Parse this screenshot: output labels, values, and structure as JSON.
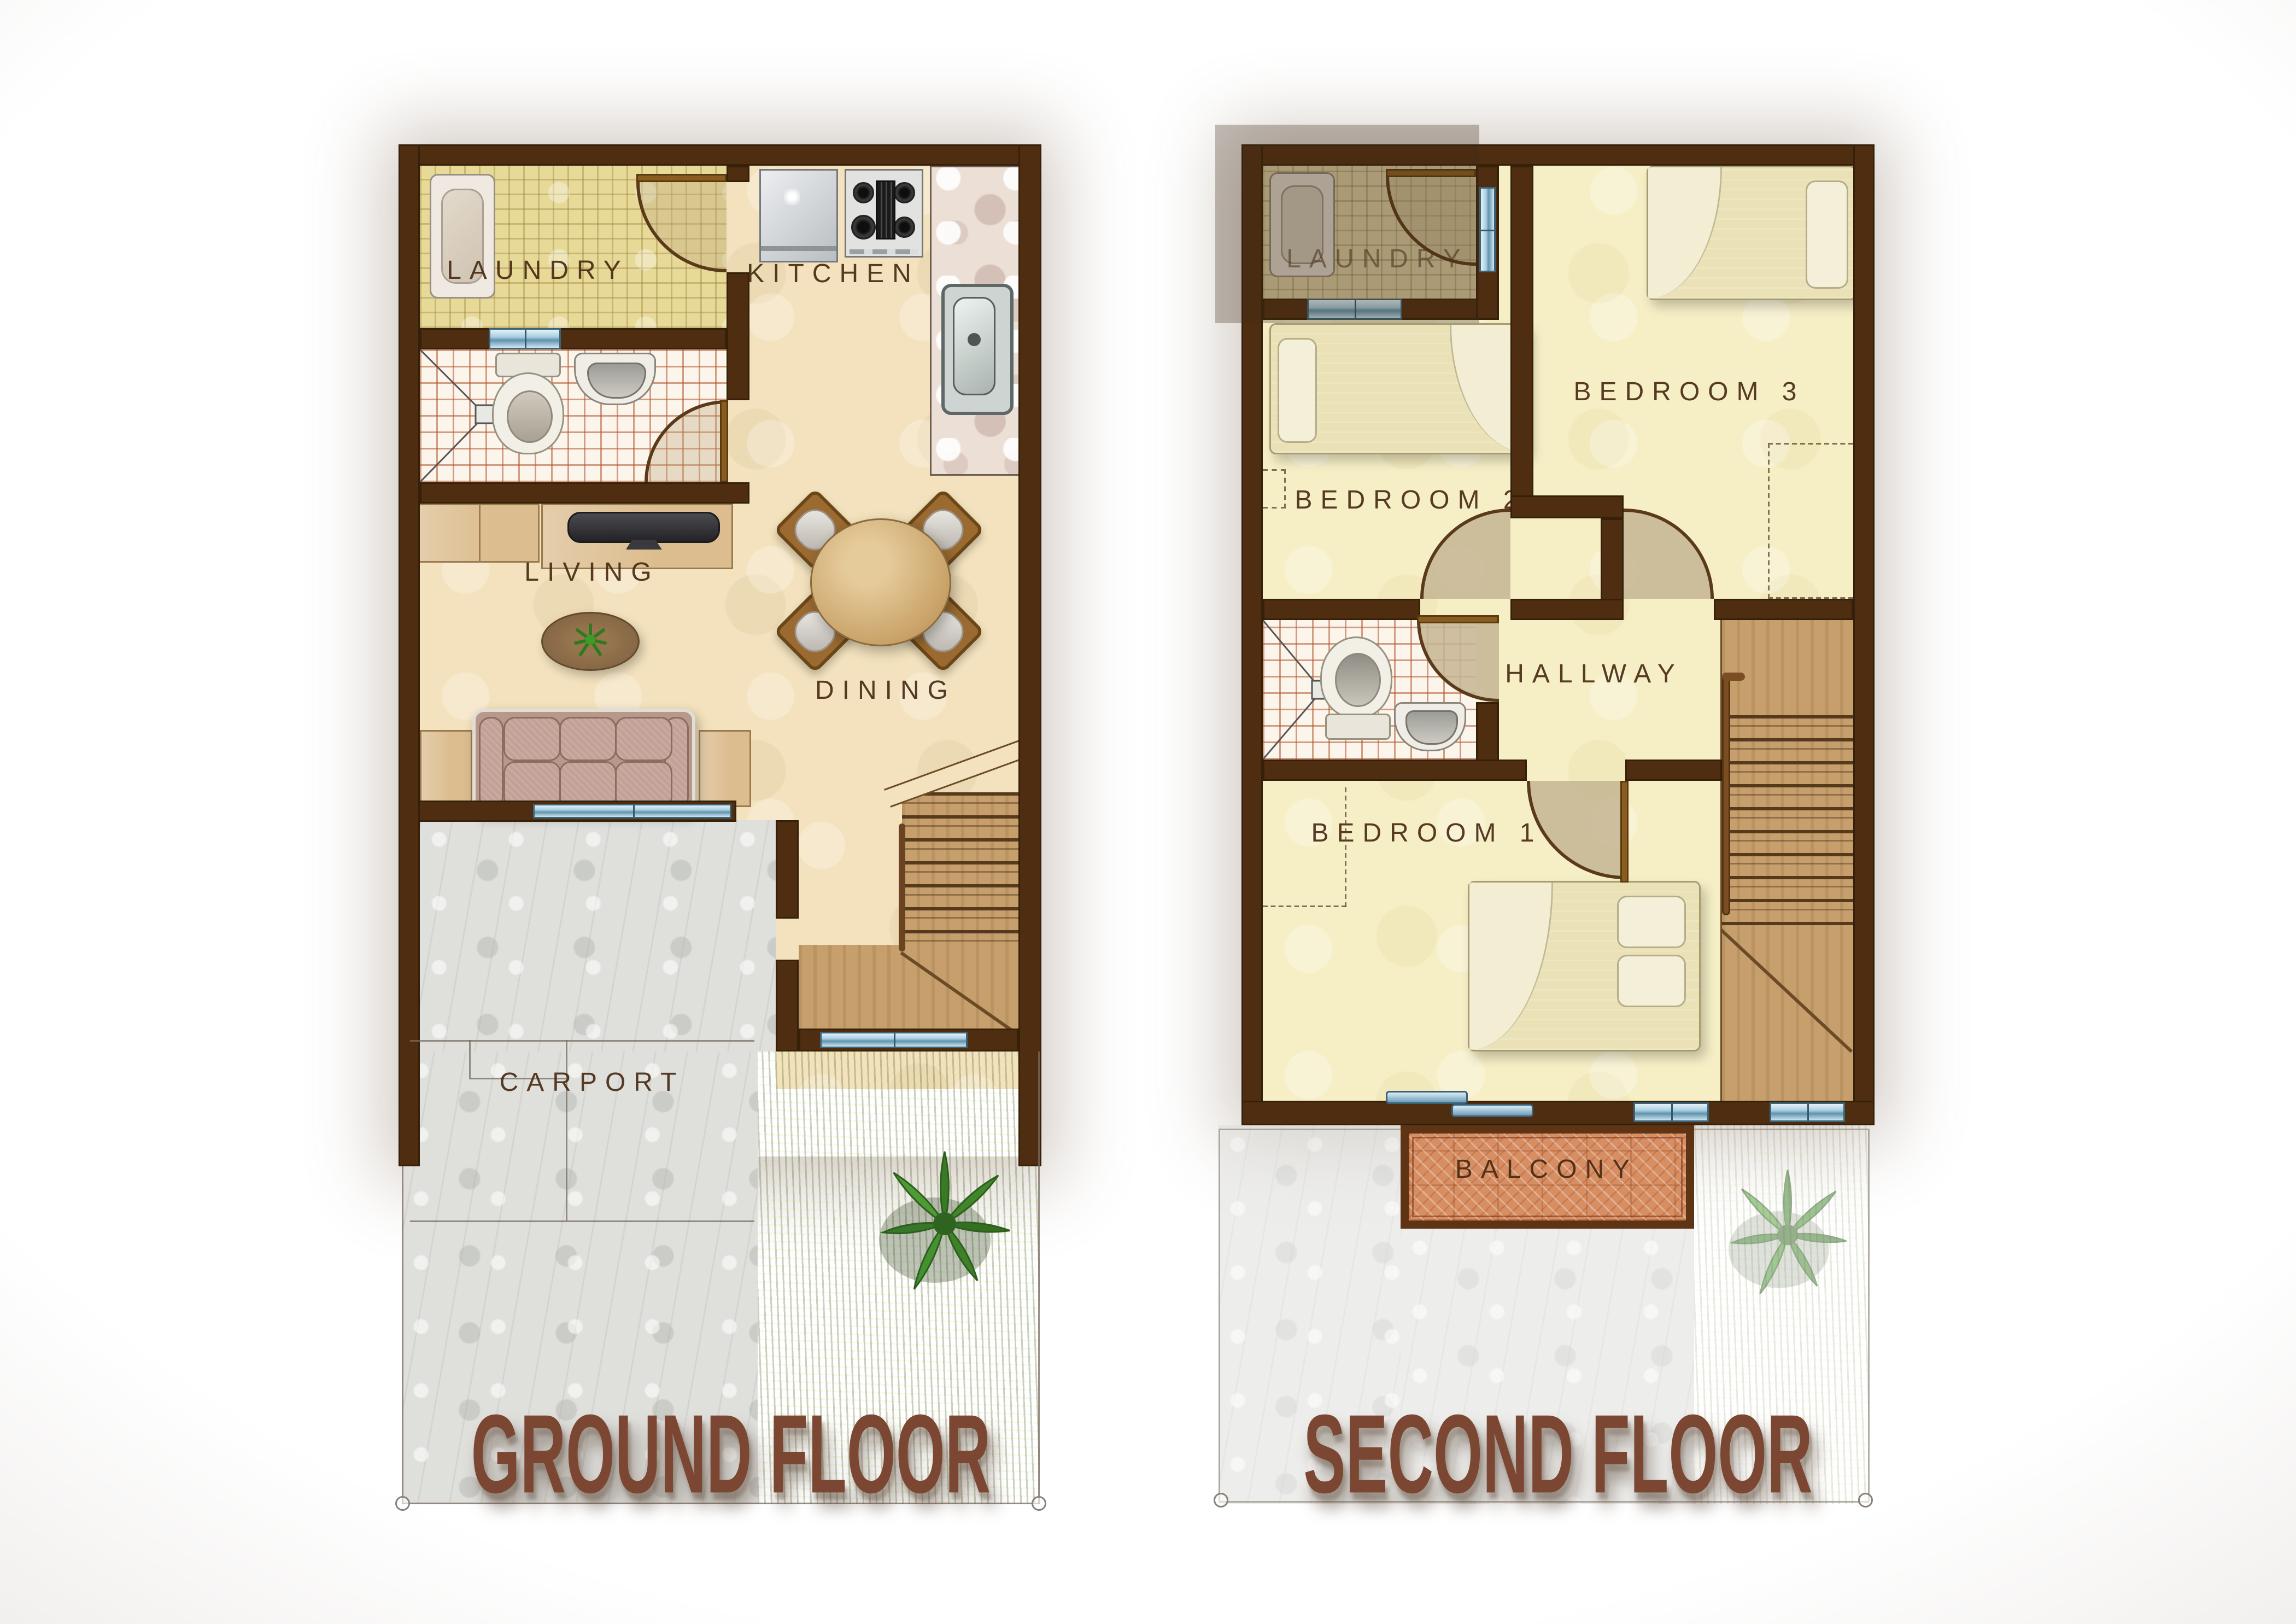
{
  "ground": {
    "title": "GROUND FLOOR",
    "labels": {
      "laundry": "LAUNDRY",
      "kitchen": "KITCHEN",
      "living": "LIVING",
      "dining": "DINING",
      "carport": "CARPORT"
    }
  },
  "second": {
    "title": "SECOND FLOOR",
    "labels": {
      "laundry": "LAUNDRY",
      "bedroom3": "BEDROOM 3",
      "bedroom2": "BEDROOM 2",
      "hallway": "HALLWAY",
      "bedroom1": "BEDROOM 1",
      "balcony": "BALCONY"
    }
  },
  "colors": {
    "wall": "#4f2d10",
    "title_text": "#7b4632",
    "label_text": "#482a12",
    "window_blue": "#a9cde0",
    "floor_cream": "#f3e2bd",
    "floor_pale_yellow": "#f6efc6",
    "balcony_tile": "#d78e63",
    "grass": "#8d9c52",
    "stair_wood": "#c79f6d",
    "concrete": "#dfdfdc"
  }
}
